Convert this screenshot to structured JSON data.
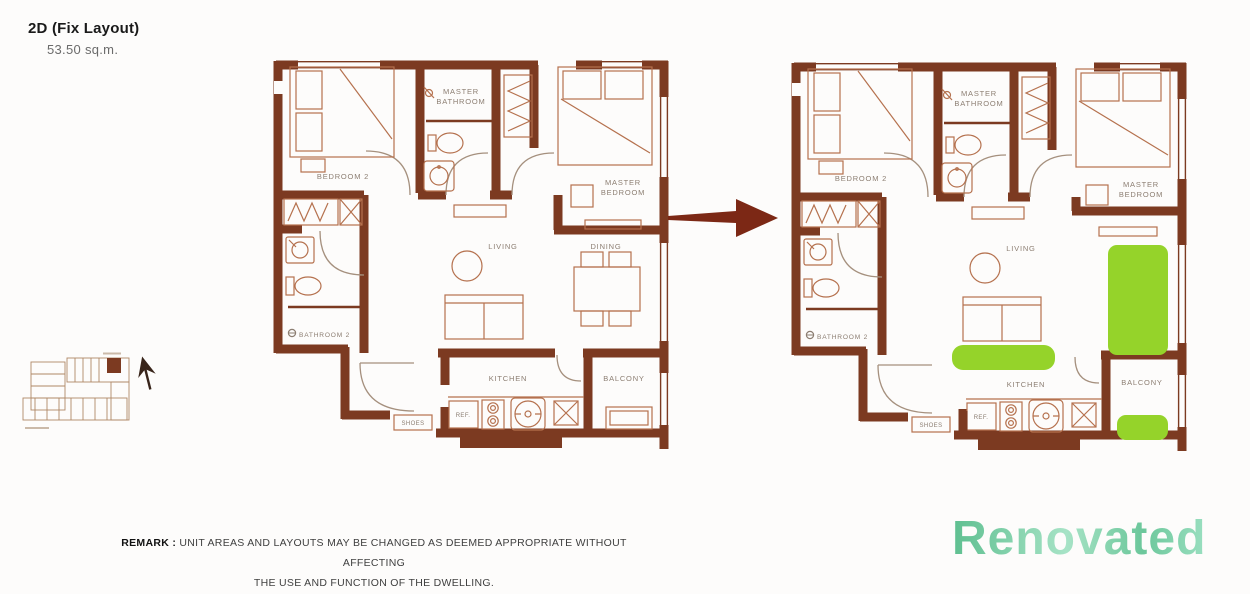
{
  "header": {
    "title": "2D (Fix Layout)",
    "area": "53.50 sq.m."
  },
  "plans": [
    {
      "rooms": {
        "bedroom2": "BEDROOM 2",
        "master_bathroom_1": "MASTER",
        "master_bathroom_2": "BATHROOM",
        "master_bedroom_1": "MASTER",
        "master_bedroom_2": "BEDROOM",
        "living": "LIVING",
        "dining": "DINING",
        "bathroom2": "BATHROOM 2",
        "kitchen": "KITCHEN",
        "balcony": "BALCONY",
        "shoes": "SHOES",
        "ref": "REF."
      }
    },
    {
      "rooms": {
        "bedroom2": "BEDROOM 2",
        "master_bathroom_1": "MASTER",
        "master_bathroom_2": "BATHROOM",
        "master_bedroom_1": "MASTER",
        "master_bedroom_2": "BEDROOM",
        "living": "LIVING",
        "bathroom2": "BATHROOM 2",
        "kitchen": "KITCHEN",
        "balcony": "BALCONY",
        "shoes": "SHOES",
        "ref": "REF."
      }
    }
  ],
  "remark": {
    "label": "REMARK :",
    "line1": "UNIT AREAS AND LAYOUTS MAY BE CHANGED AS DEEMED APPROPRIATE WITHOUT AFFECTING",
    "line2": "THE USE AND FUNCTION OF THE DWELLING."
  },
  "watermark": {
    "text": "Renovated"
  },
  "colors": {
    "wall": "#7c3a21",
    "furniture_line": "#b5714e",
    "room_label": "#8c7e72",
    "highlight_green": "#95d32a",
    "arrow": "#7c2815",
    "watermark_green_start": "#5ebf90",
    "watermark_green_end": "#a7e3c6"
  }
}
